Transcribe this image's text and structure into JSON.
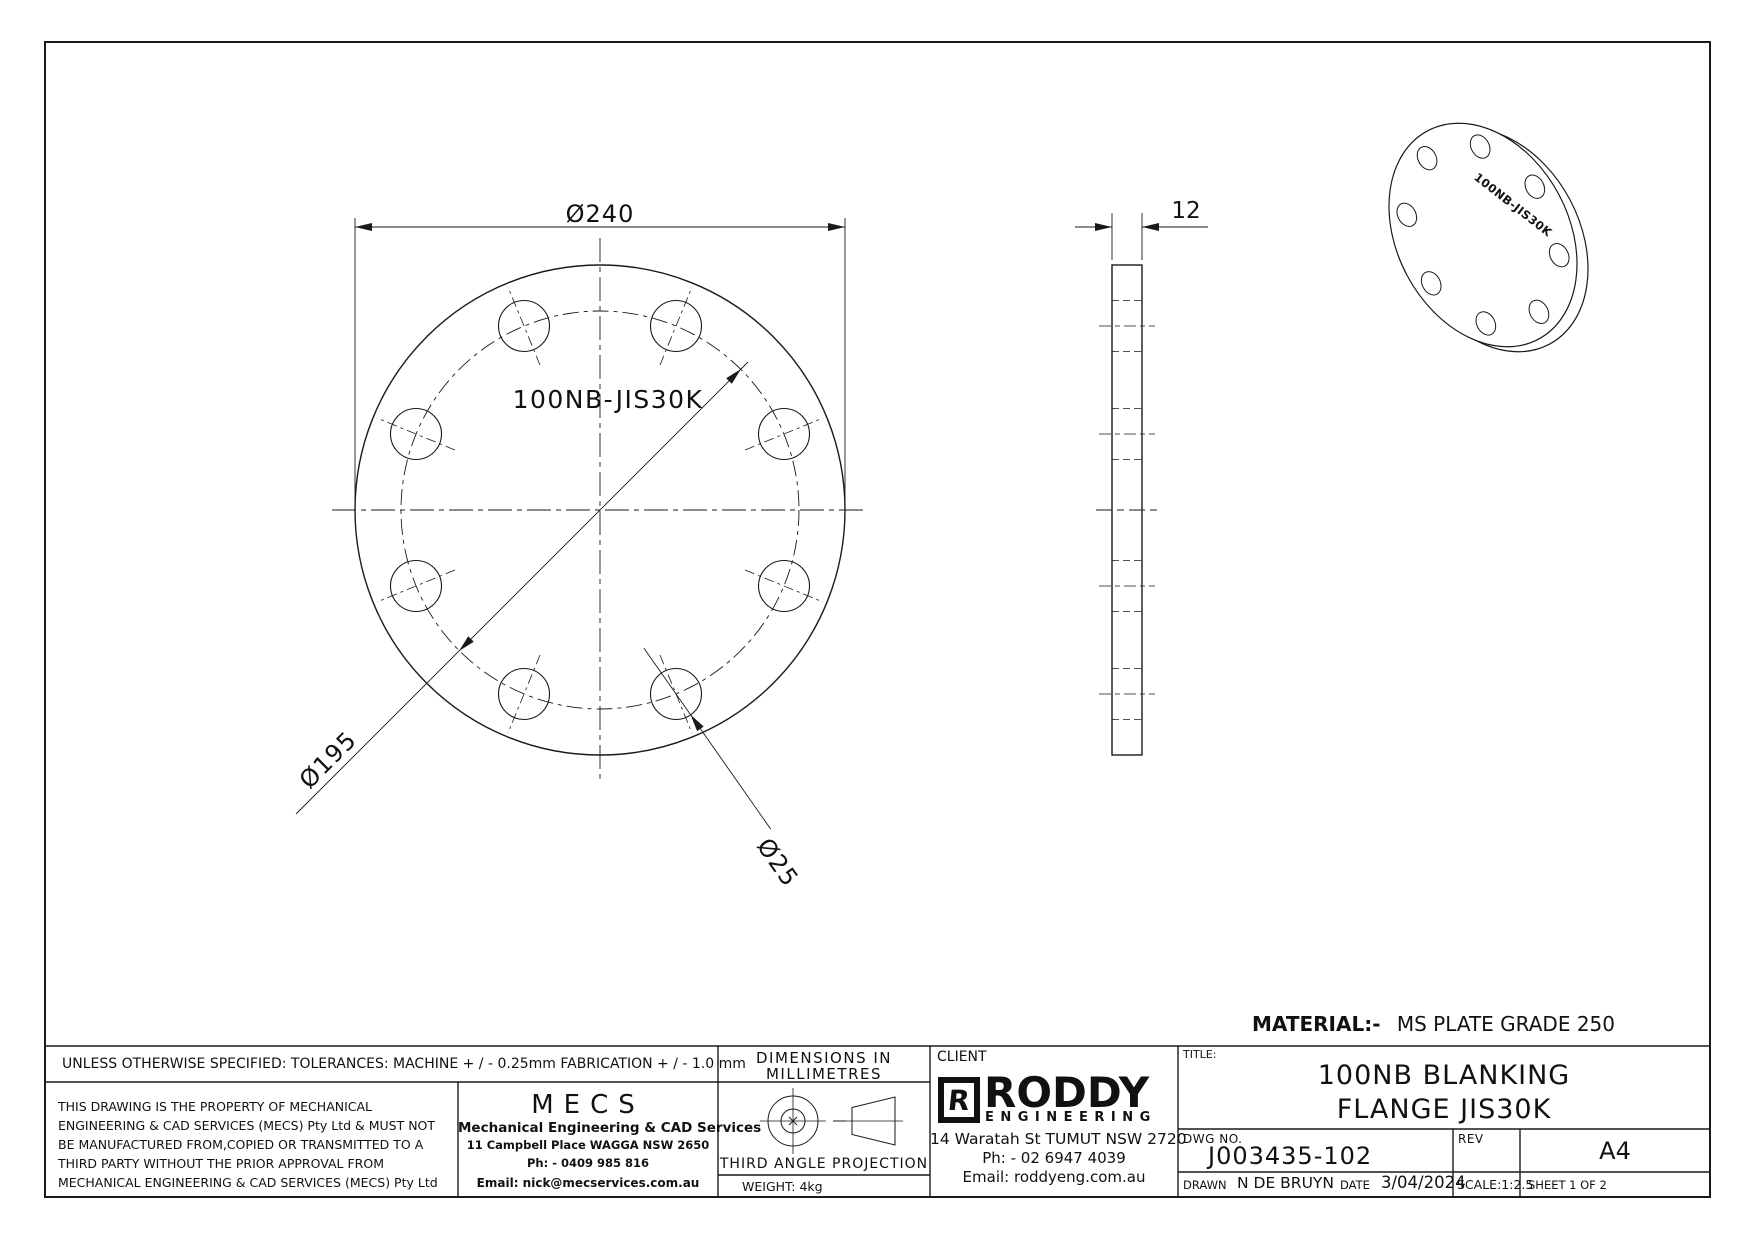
{
  "drawing": {
    "front_view": {
      "label": "100NB-JIS30K",
      "dim_outer": "Ø240",
      "dim_bolt_circle": "Ø195",
      "dim_hole": "Ø25"
    },
    "side_view": {
      "dim_thickness": "12"
    },
    "iso_view": {
      "label": "100NB-JIS30K"
    },
    "material_note": {
      "label": "MATERIAL:-",
      "value": "MS PLATE GRADE 250"
    }
  },
  "title_block": {
    "tolerances": "UNLESS OTHERWISE SPECIFIED: TOLERANCES: MACHINE + / - 0.25mm  FABRICATION + / - 1.0 mm",
    "property_note": [
      "THIS DRAWING IS THE PROPERTY OF MECHANICAL",
      "ENGINEERING & CAD SERVICES (MECS) Pty Ltd & MUST NOT",
      "BE MANUFACTURED FROM,COPIED OR TRANSMITTED TO A",
      "THIRD PARTY WITHOUT THE PRIOR APPROVAL FROM",
      "MECHANICAL ENGINEERING & CAD SERVICES (MECS) Pty Ltd"
    ],
    "mecs": {
      "logo": "MECS",
      "name": "Mechanical Engineering & CAD Services",
      "address": "11 Campbell Place WAGGA NSW 2650",
      "phone": "Ph: - 0409 985 816",
      "email": "Email: nick@mecservices.com.au"
    },
    "units": {
      "line1": "DIMENSIONS IN",
      "line2": "MILLIMETRES"
    },
    "projection": "THIRD ANGLE PROJECTION",
    "weight": "WEIGHT: 4kg",
    "client": {
      "label": "CLIENT",
      "logo_r": "R",
      "logo_name": "RODDY",
      "logo_sub": "ENGINEERING",
      "address": "14 Waratah St TUMUT NSW 2720",
      "phone": "Ph: - 02 6947 4039",
      "email": "Email: roddyeng.com.au"
    },
    "title": {
      "label": "TITLE:",
      "line1": "100NB BLANKING",
      "line2": "FLANGE JIS30K"
    },
    "dwg": {
      "label": "DWG NO.",
      "value": "J003435-102"
    },
    "rev": {
      "label": "REV",
      "value": ""
    },
    "size": "A4",
    "drawn": {
      "label": "DRAWN",
      "value": "N DE BRUYN"
    },
    "date": {
      "label": "DATE",
      "value": "3/04/2024"
    },
    "scale": "SCALE:1:2.5",
    "sheet": "SHEET 1 OF 2"
  },
  "colors": {
    "line": "#1a1a1a",
    "background": "#ffffff"
  }
}
